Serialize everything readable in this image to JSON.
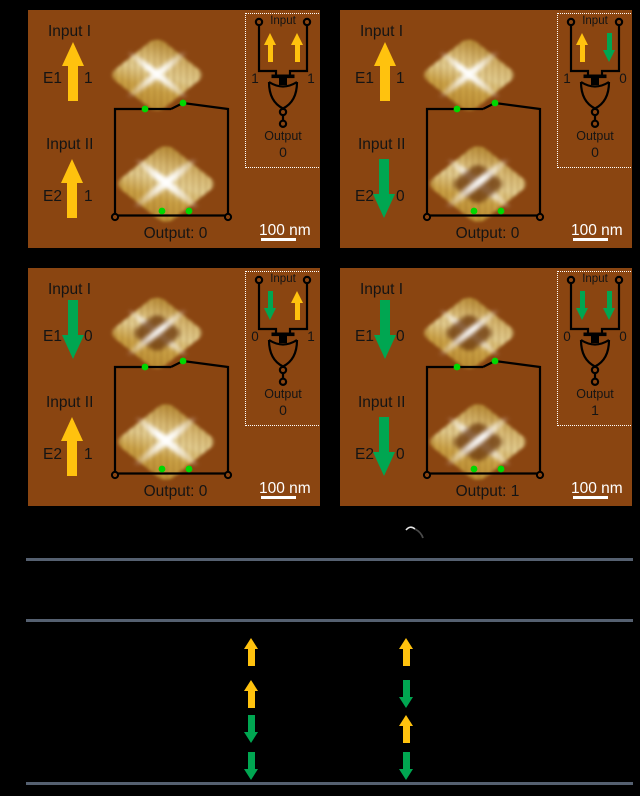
{
  "colors": {
    "panel_bg": "#8a4511",
    "arrow_up_yellow": "#FFC20E",
    "arrow_down_green": "#00A651",
    "table_line": "#556070",
    "contact_dot_green": "#00d800",
    "scalebar_white": "#ffffff"
  },
  "panels": [
    {
      "state": "11",
      "input1": {
        "label": "Input I",
        "e": "E1",
        "bit": "1",
        "arrow": {
          "dir": "up",
          "color": "#FFC20E"
        }
      },
      "input2": {
        "label": "Input II",
        "e": "E2",
        "bit": "1",
        "arrow": {
          "dir": "up",
          "color": "#FFC20E"
        }
      },
      "output": "Output: 0",
      "scalebar": "100 nm",
      "diamond1_hole": false,
      "diamond2_hole": false,
      "inset": {
        "title": "Input",
        "left_bit": "1",
        "right_bit": "1",
        "left_arrow": {
          "dir": "up",
          "color": "#FFC20E"
        },
        "right_arrow": {
          "dir": "up",
          "color": "#FFC20E"
        },
        "output_label": "Output",
        "output_value": "0"
      }
    },
    {
      "state": "10",
      "input1": {
        "label": "Input I",
        "e": "E1",
        "bit": "1",
        "arrow": {
          "dir": "up",
          "color": "#FFC20E"
        }
      },
      "input2": {
        "label": "Input II",
        "e": "E2",
        "bit": "0",
        "arrow": {
          "dir": "down",
          "color": "#00A651"
        }
      },
      "output": "Output: 0",
      "scalebar": "100 nm",
      "diamond1_hole": false,
      "diamond2_hole": true,
      "inset": {
        "title": "Input",
        "left_bit": "1",
        "right_bit": "0",
        "left_arrow": {
          "dir": "up",
          "color": "#FFC20E"
        },
        "right_arrow": {
          "dir": "down",
          "color": "#00A651"
        },
        "output_label": "Output",
        "output_value": "0"
      }
    },
    {
      "state": "01",
      "input1": {
        "label": "Input I",
        "e": "E1",
        "bit": "0",
        "arrow": {
          "dir": "down",
          "color": "#00A651"
        }
      },
      "input2": {
        "label": "Input II",
        "e": "E2",
        "bit": "1",
        "arrow": {
          "dir": "up",
          "color": "#FFC20E"
        }
      },
      "output": "Output: 0",
      "scalebar": "100 nm",
      "diamond1_hole": true,
      "diamond2_hole": false,
      "inset": {
        "title": "Input",
        "left_bit": "0",
        "right_bit": "1",
        "left_arrow": {
          "dir": "down",
          "color": "#00A651"
        },
        "right_arrow": {
          "dir": "up",
          "color": "#FFC20E"
        },
        "output_label": "Output",
        "output_value": "0"
      }
    },
    {
      "state": "00",
      "input1": {
        "label": "Input I",
        "e": "E1",
        "bit": "0",
        "arrow": {
          "dir": "down",
          "color": "#00A651"
        }
      },
      "input2": {
        "label": "Input II",
        "e": "E2",
        "bit": "0",
        "arrow": {
          "dir": "down",
          "color": "#00A651"
        }
      },
      "output": "Output: 1",
      "scalebar": "100 nm",
      "diamond1_hole": true,
      "diamond2_hole": true,
      "inset": {
        "title": "Input",
        "left_bit": "0",
        "right_bit": "0",
        "left_arrow": {
          "dir": "down",
          "color": "#00A651"
        },
        "right_arrow": {
          "dir": "down",
          "color": "#00A651"
        },
        "output_label": "Output",
        "output_value": "1"
      }
    }
  ],
  "truth_table": {
    "rows": [
      {
        "i1": {
          "dir": "up",
          "color": "#FFC20E"
        },
        "i2": {
          "dir": "up",
          "color": "#FFC20E"
        }
      },
      {
        "i1": {
          "dir": "up",
          "color": "#FFC20E"
        },
        "i2": {
          "dir": "down",
          "color": "#00A651"
        }
      },
      {
        "i1": {
          "dir": "down",
          "color": "#00A651"
        },
        "i2": {
          "dir": "up",
          "color": "#FFC20E"
        }
      },
      {
        "i1": {
          "dir": "down",
          "color": "#00A651"
        },
        "i2": {
          "dir": "down",
          "color": "#00A651"
        }
      }
    ]
  }
}
